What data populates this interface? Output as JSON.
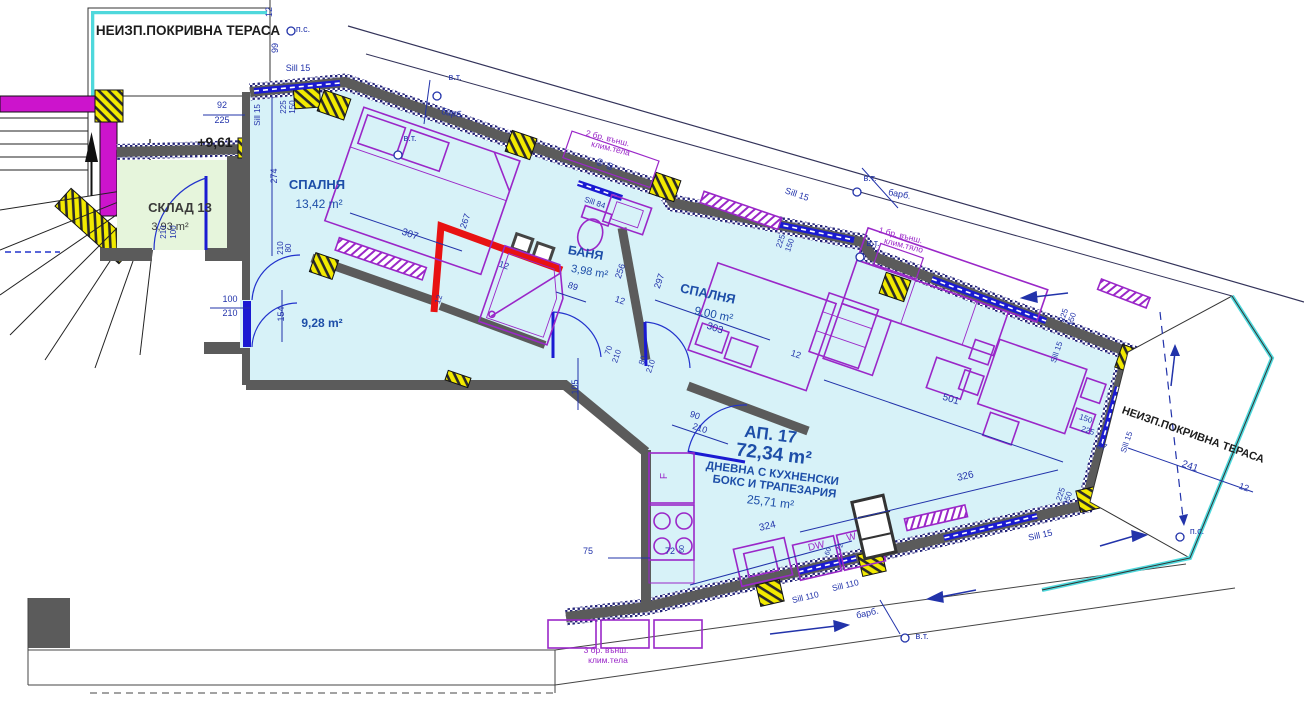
{
  "drawing_type": "apartment floor plan",
  "apartment": {
    "number": "АП. 17",
    "total_area": "72,34 m²",
    "level": "+9,61"
  },
  "rooms": [
    {
      "name": "СПАЛНЯ",
      "area": "13,42 m²"
    },
    {
      "name": "БАНЯ",
      "area": "3,98 m²"
    },
    {
      "name": "СПАЛНЯ",
      "area": "9,00 m²"
    },
    {
      "name": "ДНЕВНА С КУХНЕНСКИ БОКС И ТРАПЕЗАРИЯ",
      "area": "25,71 m²"
    },
    {
      "name": "КОРИДОР (без надпис)",
      "area": "9,28 m²"
    },
    {
      "name": "СКЛАД 13",
      "area": "3,93 m²"
    },
    {
      "name": "НЕИЗП.ПОКРИВНА ТЕРАСА",
      "area": ""
    },
    {
      "name": "НЕИЗП.ПОКРИВНА ТЕРАСА",
      "area": ""
    }
  ],
  "colors": {
    "interior": "#d7f2f8",
    "storage": "#e6f5dc",
    "wall": "#5b5b5b",
    "magenta": "#cc14cc",
    "yellow": "#f2ea00",
    "window_blue": "#1a1ad2",
    "dim": "#2233aa",
    "room": "#1d4ea8",
    "black": "#1c1c1c",
    "purple": "#9a27c8",
    "gray": "#3a3a3a",
    "highlight_red": "#e81212",
    "railing_cyan": "#4fd8dc"
  },
  "labels": [
    {
      "id": "terrace-top",
      "t": "НЕИЗП.ПОКРИВНА ТЕРАСА",
      "x": 188,
      "y": 35,
      "r": 0,
      "s": 13.5,
      "c": "black",
      "w": 600
    },
    {
      "id": "ps-top",
      "t": "п.с.",
      "x": 303,
      "y": 32,
      "r": 0,
      "s": 9,
      "c": "dim"
    },
    {
      "id": "dim-12-top",
      "t": "12",
      "x": 272,
      "y": 12,
      "r": -90,
      "s": 9,
      "c": "dim"
    },
    {
      "id": "dim-99",
      "t": "99",
      "x": 278,
      "y": 48,
      "r": -90,
      "s": 9,
      "c": "dim"
    },
    {
      "id": "sill15-a",
      "t": "Sill 15",
      "x": 298,
      "y": 71,
      "r": 0,
      "s": 9,
      "c": "dim"
    },
    {
      "id": "dim-92",
      "t": "92",
      "x": 222,
      "y": 108,
      "r": 0,
      "s": 9,
      "c": "dim"
    },
    {
      "id": "dim-225-a",
      "t": "225",
      "x": 222,
      "y": 123,
      "r": 0,
      "s": 9,
      "c": "dim"
    },
    {
      "id": "sill15-b",
      "t": "Sill 15",
      "x": 260,
      "y": 115,
      "r": -90,
      "s": 8,
      "c": "dim"
    },
    {
      "id": "dim-150-a",
      "t": "150",
      "x": 295,
      "y": 107,
      "r": -90,
      "s": 8,
      "c": "dim"
    },
    {
      "id": "dim-225-b",
      "t": "225",
      "x": 286,
      "y": 107,
      "r": -90,
      "s": 8,
      "c": "dim"
    },
    {
      "id": "dim-274",
      "t": "274",
      "x": 277,
      "y": 176,
      "r": -90,
      "s": 9,
      "c": "dim"
    },
    {
      "id": "level",
      "t": "+9,61",
      "x": 215,
      "y": 147,
      "r": 0,
      "s": 14,
      "c": "black",
      "w": 600
    },
    {
      "id": "sklad",
      "t": "СКЛАД 13",
      "x": 180,
      "y": 212,
      "r": 0,
      "s": 13,
      "c": "gray",
      "w": 600
    },
    {
      "id": "sklad-area",
      "t": "3,93 m²",
      "x": 170,
      "y": 230,
      "r": 0,
      "s": 11,
      "c": "gray"
    },
    {
      "id": "door-sklad-100",
      "t": "100",
      "x": 176,
      "y": 232,
      "r": -90,
      "s": 8,
      "c": "dim"
    },
    {
      "id": "door-sklad-210",
      "t": "210",
      "x": 166,
      "y": 232,
      "r": -90,
      "s": 8,
      "c": "dim"
    },
    {
      "id": "door-entry-100",
      "t": "100",
      "x": 230,
      "y": 302,
      "r": 0,
      "s": 9,
      "c": "dim"
    },
    {
      "id": "door-entry-210",
      "t": "210",
      "x": 230,
      "y": 316,
      "r": 0,
      "s": 9,
      "c": "dim"
    },
    {
      "id": "bedroom1",
      "t": "СПАЛНЯ",
      "x": 317,
      "y": 189,
      "r": 0,
      "s": 13,
      "c": "room",
      "w": 600
    },
    {
      "id": "bedroom1-area",
      "t": "13,42 m²",
      "x": 319,
      "y": 208,
      "r": 0,
      "s": 12,
      "c": "room"
    },
    {
      "id": "dim-307",
      "t": "307",
      "x": 409,
      "y": 237,
      "r": 19,
      "s": 10,
      "c": "dim"
    },
    {
      "id": "dim-267",
      "t": "267",
      "x": 468,
      "y": 222,
      "r": -71,
      "s": 9,
      "c": "dim"
    },
    {
      "id": "door-b1-80",
      "t": "80",
      "x": 291,
      "y": 248,
      "r": -90,
      "s": 8,
      "c": "dim"
    },
    {
      "id": "door-b1-210",
      "t": "210",
      "x": 283,
      "y": 248,
      "r": -90,
      "s": 8,
      "c": "dim"
    },
    {
      "id": "dim-154",
      "t": "154",
      "x": 284,
      "y": 314,
      "r": -90,
      "s": 9,
      "c": "dim"
    },
    {
      "id": "hall-area",
      "t": "9,28 m²",
      "x": 322,
      "y": 327,
      "r": 0,
      "s": 12,
      "c": "room",
      "w": 600
    },
    {
      "id": "banya",
      "t": "БАНЯ",
      "x": 585,
      "y": 257,
      "r": 10,
      "s": 12.5,
      "c": "room",
      "w": 600
    },
    {
      "id": "banya-area",
      "t": "3,98 m²",
      "x": 589,
      "y": 275,
      "r": 10,
      "s": 11,
      "c": "room"
    },
    {
      "id": "dim-256",
      "t": "256",
      "x": 623,
      "y": 272,
      "r": -71,
      "s": 9,
      "c": "dim"
    },
    {
      "id": "dim-297",
      "t": "297",
      "x": 662,
      "y": 282,
      "r": -71,
      "s": 9,
      "c": "dim"
    },
    {
      "id": "sill84",
      "t": "Sill 84",
      "x": 594,
      "y": 205,
      "r": 19,
      "s": 8,
      "c": "dim"
    },
    {
      "id": "ac2-l1",
      "t": "2 бр. външ.",
      "x": 607,
      "y": 141,
      "r": 14,
      "s": 8.5,
      "c": "purple"
    },
    {
      "id": "ac2-l2",
      "t": "клим.тела",
      "x": 610,
      "y": 151,
      "r": 14,
      "s": 8.5,
      "c": "purple"
    },
    {
      "id": "dim-60-a",
      "t": "60",
      "x": 602,
      "y": 163,
      "r": -71,
      "s": 7,
      "c": "dim"
    },
    {
      "id": "dim-80-a",
      "t": "80",
      "x": 612,
      "y": 167,
      "r": -71,
      "s": 7,
      "c": "dim"
    },
    {
      "id": "vt-1",
      "t": "в.т.",
      "x": 455,
      "y": 80,
      "r": 0,
      "s": 9,
      "c": "dim"
    },
    {
      "id": "barb-1",
      "t": "барб.",
      "x": 452,
      "y": 116,
      "r": 10,
      "s": 9,
      "c": "dim"
    },
    {
      "id": "vt-2",
      "t": "в.т.",
      "x": 410,
      "y": 141,
      "r": 0,
      "s": 9,
      "c": "dim"
    },
    {
      "id": "vt-3",
      "t": "в.т.",
      "x": 870,
      "y": 181,
      "r": 0,
      "s": 9,
      "c": "dim"
    },
    {
      "id": "barb-2",
      "t": "барб.",
      "x": 899,
      "y": 197,
      "r": 10,
      "s": 9,
      "c": "dim"
    },
    {
      "id": "vt-4",
      "t": "в.т.",
      "x": 873,
      "y": 246,
      "r": 0,
      "s": 9,
      "c": "dim"
    },
    {
      "id": "ac1-l1",
      "t": "1 бр. външ.",
      "x": 900,
      "y": 238,
      "r": 14,
      "s": 8.5,
      "c": "purple"
    },
    {
      "id": "ac1-l2",
      "t": "клим.тяло",
      "x": 903,
      "y": 248,
      "r": 14,
      "s": 8.5,
      "c": "purple"
    },
    {
      "id": "sill15-c",
      "t": "Sill 15",
      "x": 796,
      "y": 197,
      "r": 19,
      "s": 9,
      "c": "dim"
    },
    {
      "id": "dim-225-c",
      "t": "225",
      "x": 783,
      "y": 242,
      "r": -71,
      "s": 8,
      "c": "dim"
    },
    {
      "id": "dim-150-c",
      "t": "150",
      "x": 792,
      "y": 246,
      "r": -71,
      "s": 8,
      "c": "dim"
    },
    {
      "id": "bedroom2",
      "t": "СПАЛНЯ",
      "x": 707,
      "y": 298,
      "r": 12,
      "s": 13,
      "c": "room",
      "w": 600
    },
    {
      "id": "bedroom2-area",
      "t": "9,00 m²",
      "x": 713,
      "y": 318,
      "r": 12,
      "s": 11.5,
      "c": "room"
    },
    {
      "id": "dim-303",
      "t": "303",
      "x": 714,
      "y": 331,
      "r": 19,
      "s": 10,
      "c": "dim"
    },
    {
      "id": "dim-12-a",
      "t": "12",
      "x": 619,
      "y": 303,
      "r": 19,
      "s": 9,
      "c": "dim"
    },
    {
      "id": "dim-12-b",
      "t": "12",
      "x": 795,
      "y": 357,
      "r": 19,
      "s": 9,
      "c": "dim"
    },
    {
      "id": "dim-12-c",
      "t": "12",
      "x": 503,
      "y": 268,
      "r": 19,
      "s": 9,
      "c": "dim"
    },
    {
      "id": "dim-12-g",
      "t": "12",
      "x": 441,
      "y": 300,
      "r": -71,
      "s": 8,
      "c": "dim"
    },
    {
      "id": "dim-89",
      "t": "89",
      "x": 572,
      "y": 289,
      "r": 19,
      "s": 9,
      "c": "dim"
    },
    {
      "id": "dim-105",
      "t": "105",
      "x": 578,
      "y": 387,
      "r": -90,
      "s": 9,
      "c": "dim"
    },
    {
      "id": "door-bath-70",
      "t": "70",
      "x": 611,
      "y": 351,
      "r": -71,
      "s": 8,
      "c": "dim"
    },
    {
      "id": "door-bath-210",
      "t": "210",
      "x": 619,
      "y": 357,
      "r": -71,
      "s": 8,
      "c": "dim"
    },
    {
      "id": "door-b2-80",
      "t": "80",
      "x": 645,
      "y": 361,
      "r": -71,
      "s": 8,
      "c": "dim"
    },
    {
      "id": "door-b2-210",
      "t": "210",
      "x": 653,
      "y": 367,
      "r": -71,
      "s": 8,
      "c": "dim"
    },
    {
      "id": "door-liv-90",
      "t": "90",
      "x": 694,
      "y": 418,
      "r": 19,
      "s": 9,
      "c": "dim"
    },
    {
      "id": "door-liv-210",
      "t": "210",
      "x": 699,
      "y": 431,
      "r": 19,
      "s": 9,
      "c": "dim"
    },
    {
      "id": "ap-number",
      "t": "АП. 17",
      "x": 770,
      "y": 440,
      "r": 7,
      "s": 17,
      "c": "room",
      "w": 700
    },
    {
      "id": "ap-area",
      "t": "72,34 m²",
      "x": 773,
      "y": 460,
      "r": 7,
      "s": 19,
      "c": "room",
      "w": 700
    },
    {
      "id": "living-l1",
      "t": "ДНЕВНА С КУХНЕНСКИ",
      "x": 772,
      "y": 477,
      "r": 7,
      "s": 11.5,
      "c": "room",
      "w": 600
    },
    {
      "id": "living-l2",
      "t": "БОКС И ТРАПЕЗАРИЯ",
      "x": 774,
      "y": 490,
      "r": 7,
      "s": 11.5,
      "c": "room",
      "w": 600
    },
    {
      "id": "living-area",
      "t": "25,71 m²",
      "x": 770,
      "y": 506,
      "r": 7,
      "s": 12,
      "c": "room"
    },
    {
      "id": "dim-501",
      "t": "501",
      "x": 950,
      "y": 402,
      "r": 17,
      "s": 10,
      "c": "dim"
    },
    {
      "id": "dim-326",
      "t": "326",
      "x": 966,
      "y": 479,
      "r": -13,
      "s": 10,
      "c": "dim"
    },
    {
      "id": "dim-324",
      "t": "324",
      "x": 768,
      "y": 529,
      "r": -13,
      "s": 10,
      "c": "dim"
    },
    {
      "id": "dim-72",
      "t": "72",
      "x": 670,
      "y": 554,
      "r": 0,
      "s": 9,
      "c": "dim"
    },
    {
      "id": "dim-75",
      "t": "75",
      "x": 588,
      "y": 554,
      "r": 0,
      "s": 9,
      "c": "dim"
    },
    {
      "id": "dim-60-b",
      "t": "60",
      "x": 684,
      "y": 549,
      "r": -90,
      "s": 7,
      "c": "dim"
    },
    {
      "id": "fridge",
      "t": "F",
      "x": 667,
      "y": 476,
      "r": -90,
      "s": 10,
      "c": "purple"
    },
    {
      "id": "dw",
      "t": "DW",
      "x": 817,
      "y": 549,
      "r": -13,
      "s": 10,
      "c": "purple"
    },
    {
      "id": "washer",
      "t": "W",
      "x": 852,
      "y": 540,
      "r": -13,
      "s": 10,
      "c": "purple"
    },
    {
      "id": "dim-60-c",
      "t": "60",
      "x": 830,
      "y": 552,
      "r": -71,
      "s": 7,
      "c": "dim"
    },
    {
      "id": "dim-72-b",
      "t": "72",
      "x": 842,
      "y": 548,
      "r": -71,
      "s": 7,
      "c": "dim"
    },
    {
      "id": "sill110-a",
      "t": "Sill 110",
      "x": 806,
      "y": 600,
      "r": -13,
      "s": 8.5,
      "c": "dim"
    },
    {
      "id": "sill110-b",
      "t": "Sill 110",
      "x": 846,
      "y": 588,
      "r": -13,
      "s": 8.5,
      "c": "dim"
    },
    {
      "id": "barb-3",
      "t": "барб.",
      "x": 868,
      "y": 616,
      "r": -13,
      "s": 9,
      "c": "dim"
    },
    {
      "id": "vt-5",
      "t": "в.т.",
      "x": 922,
      "y": 639,
      "r": 0,
      "s": 9,
      "c": "dim"
    },
    {
      "id": "ac3-l1",
      "t": "3 бр. външ.",
      "x": 606,
      "y": 653,
      "r": 0,
      "s": 8.5,
      "c": "purple"
    },
    {
      "id": "ac3-l2",
      "t": "клим.тела",
      "x": 608,
      "y": 663,
      "r": 0,
      "s": 8.5,
      "c": "purple"
    },
    {
      "id": "terrace-right",
      "t": "НЕИЗП.ПОКРИВНА ТЕРАСА",
      "x": 1192,
      "y": 438,
      "r": 19.5,
      "s": 11,
      "c": "black",
      "w": 600
    },
    {
      "id": "dim-241",
      "t": "241",
      "x": 1189,
      "y": 469,
      "r": 19,
      "s": 10,
      "c": "dim"
    },
    {
      "id": "dim-12-e",
      "t": "12",
      "x": 1243,
      "y": 490,
      "r": 19,
      "s": 9,
      "c": "dim"
    },
    {
      "id": "ps-bottom",
      "t": "п.с.",
      "x": 1197,
      "y": 534,
      "r": 0,
      "s": 9,
      "c": "dim"
    },
    {
      "id": "sill15-d",
      "t": "Sill 15",
      "x": 1041,
      "y": 538,
      "r": -13,
      "s": 9,
      "c": "dim"
    },
    {
      "id": "sill15-e",
      "t": "Sill 15",
      "x": 1059,
      "y": 353,
      "r": -71,
      "s": 8,
      "c": "dim"
    },
    {
      "id": "sill15-f",
      "t": "Sill 15",
      "x": 1129,
      "y": 443,
      "r": -71,
      "s": 8,
      "c": "dim"
    },
    {
      "id": "dim-225-d",
      "t": "225",
      "x": 1066,
      "y": 316,
      "r": -71,
      "s": 8,
      "c": "dim"
    },
    {
      "id": "dim-150-d",
      "t": "150",
      "x": 1074,
      "y": 320,
      "r": -71,
      "s": 8,
      "c": "dim"
    },
    {
      "id": "dim-150-e",
      "t": "150",
      "x": 1085,
      "y": 421,
      "r": 19,
      "s": 8,
      "c": "dim"
    },
    {
      "id": "dim-225-e",
      "t": "225",
      "x": 1087,
      "y": 433,
      "r": 19,
      "s": 8,
      "c": "dim"
    },
    {
      "id": "dim-87",
      "t": "87",
      "x": 1101,
      "y": 449,
      "r": 19,
      "s": 9,
      "c": "dim"
    },
    {
      "id": "dim-225-f",
      "t": "225",
      "x": 1063,
      "y": 495,
      "r": -71,
      "s": 8,
      "c": "dim"
    },
    {
      "id": "dim-150-f",
      "t": "150",
      "x": 1070,
      "y": 499,
      "r": -71,
      "s": 8,
      "c": "dim"
    }
  ]
}
